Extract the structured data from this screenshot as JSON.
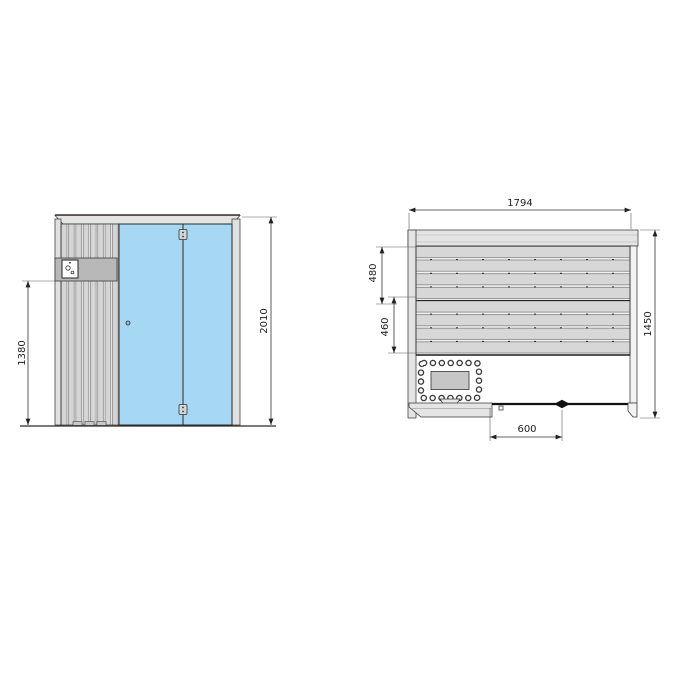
{
  "drawing": {
    "type": "sauna-dimension-drawing",
    "views": {
      "front": "front-elevation",
      "plan": "top-plan"
    },
    "colors": {
      "glass": "#a7d8f3",
      "wood_slat": "#d5d5d5",
      "wall_band": "#e4e4e4",
      "control_panel": "#b8b8b8",
      "heater_inner": "#c6c6c6",
      "line": "#2e2e2e",
      "top_trim": "#7a6257"
    },
    "front_view": {
      "dims": {
        "total_height": "2010",
        "control_panel_height": "1380"
      }
    },
    "plan_view": {
      "dims": {
        "total_width": "1794",
        "total_depth": "1450",
        "upper_bench_depth": "480",
        "lower_bench_depth": "460",
        "door_width": "600"
      }
    }
  }
}
